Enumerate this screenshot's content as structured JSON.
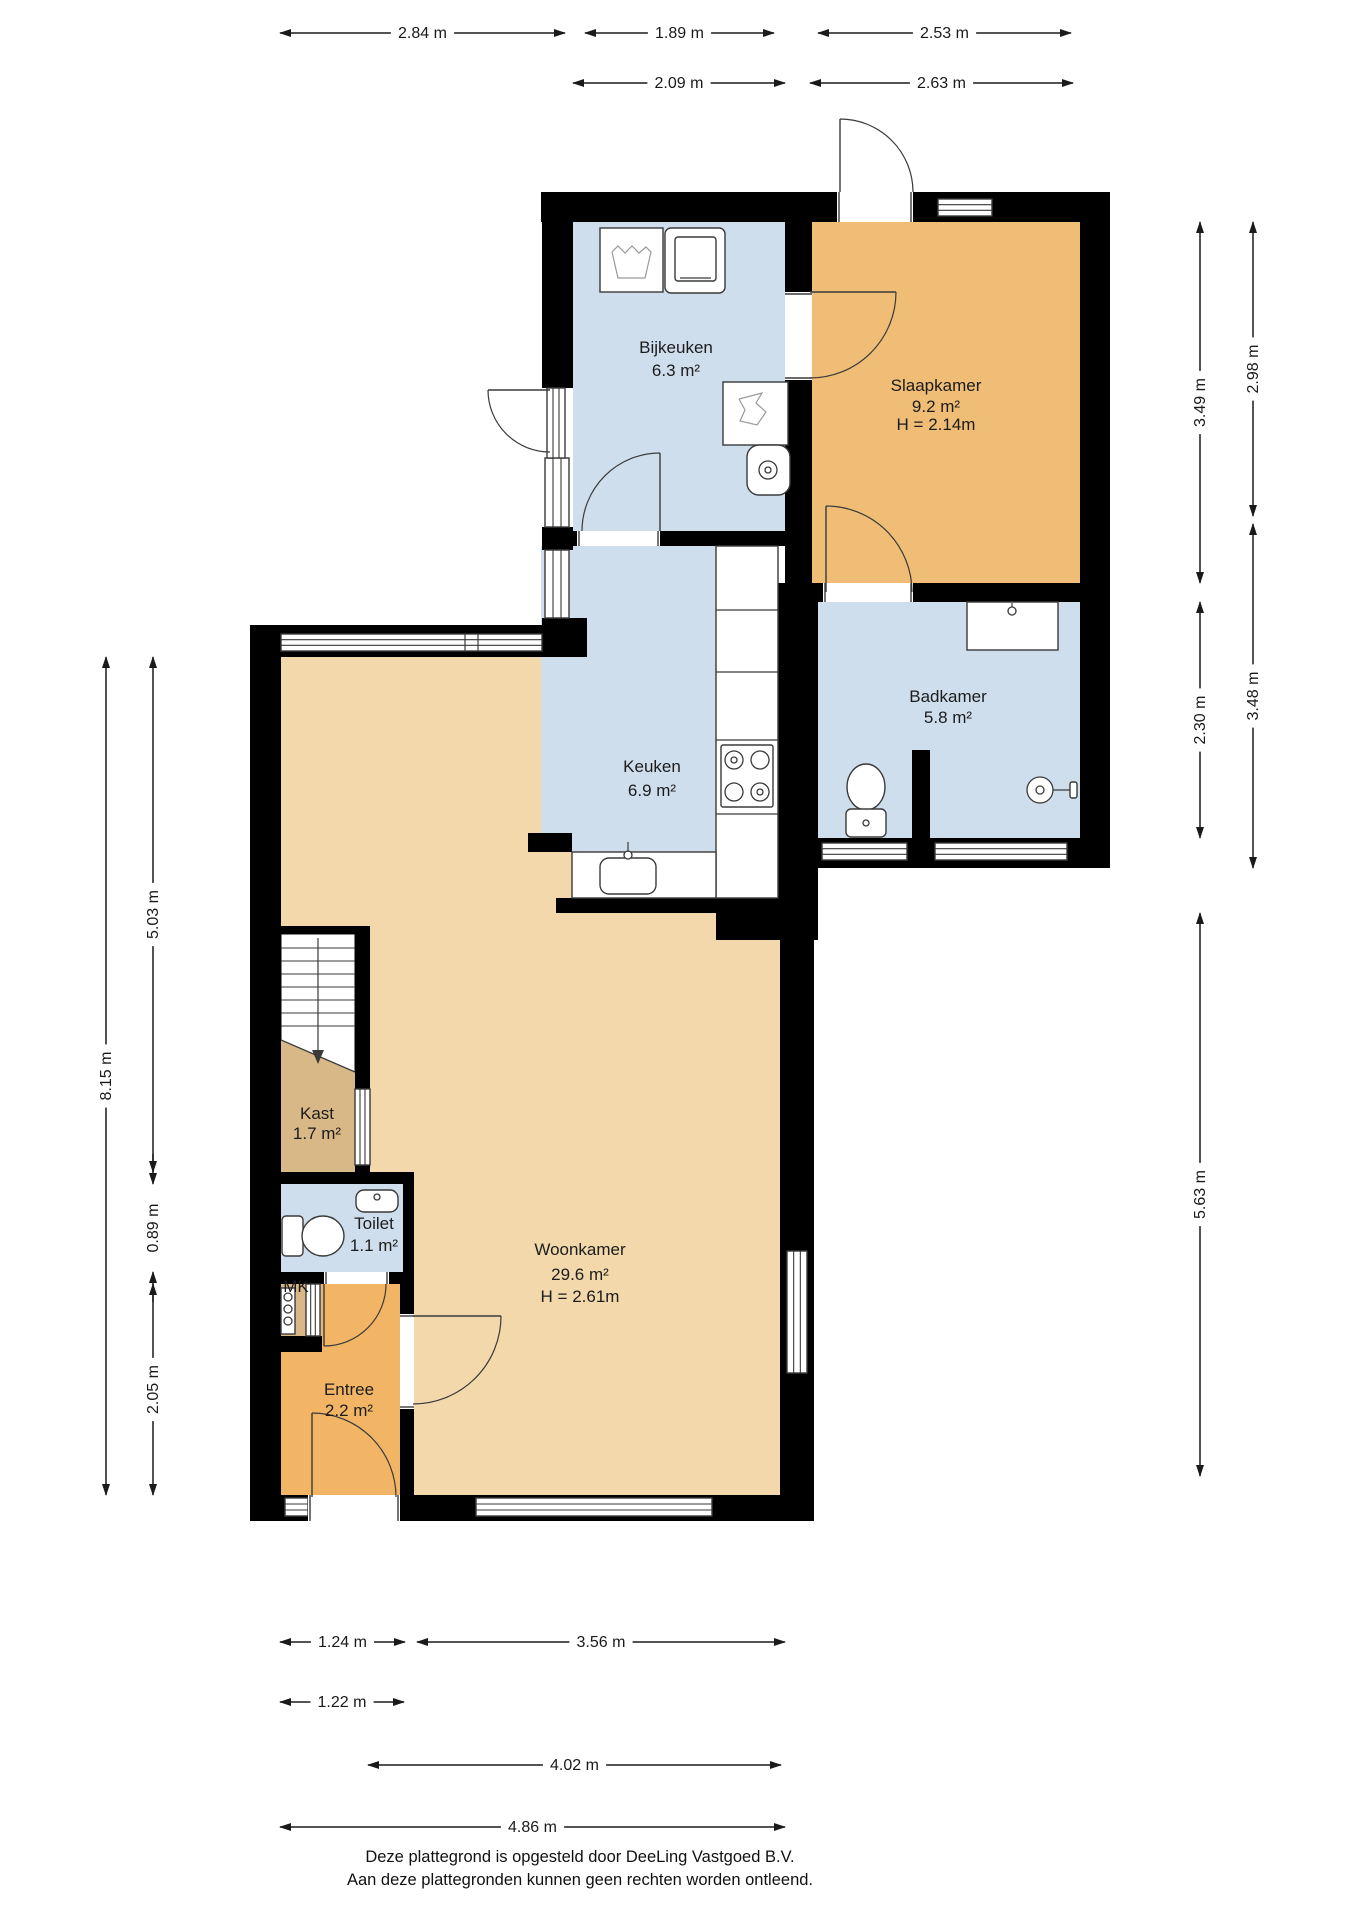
{
  "canvas": {
    "width": 1358,
    "height": 1920,
    "background": "#ffffff"
  },
  "colors": {
    "wall": "#000000",
    "room_blue": "#cfdeed",
    "room_orange": "#efbd75",
    "room_entree": "#f2b566",
    "room_tan": "#f2d8ab",
    "room_darktan": "#d9b887",
    "stroke": "#3a3a3a",
    "dim": "#1a1a1a"
  },
  "plan": {
    "rooms": [
      {
        "id": "woonkamer",
        "color": "#f2d8ab",
        "rect": [
          281,
          657,
          499,
          838
        ],
        "label": {
          "cx": 580,
          "lines": [
            {
              "text": "Woonkamer",
              "y": 1255
            },
            {
              "text": "29.6 m²",
              "y": 1280
            },
            {
              "text": "H = 2.61m",
              "y": 1302
            }
          ]
        }
      },
      {
        "id": "keuken",
        "color": "#cfdeed",
        "rect": [
          541,
          546,
          237,
          306
        ],
        "label": {
          "cx": 652,
          "lines": [
            {
              "text": "Keuken",
              "y": 772
            },
            {
              "text": "6.9 m²",
              "y": 796
            }
          ]
        }
      },
      {
        "id": "bijkeuken",
        "color": "#cfdeed",
        "rect": [
          573,
          222,
          212,
          309
        ],
        "label": {
          "cx": 676,
          "lines": [
            {
              "text": "Bijkeuken",
              "y": 353
            },
            {
              "text": "6.3 m²",
              "y": 376
            }
          ]
        }
      },
      {
        "id": "slaapkamer",
        "color": "#efbd75",
        "rect": [
          812,
          222,
          268,
          361
        ],
        "label": {
          "cx": 936,
          "lines": [
            {
              "text": "Slaapkamer",
              "y": 391
            },
            {
              "text": "9.2 m²",
              "y": 412
            },
            {
              "text": "H = 2.14m",
              "y": 430
            }
          ]
        }
      },
      {
        "id": "badkamer",
        "color": "#cfdeed",
        "rect": [
          818,
          602,
          262,
          236
        ],
        "label": {
          "cx": 948,
          "lines": [
            {
              "text": "Badkamer",
              "y": 702
            },
            {
              "text": "5.8 m²",
              "y": 723
            }
          ]
        }
      },
      {
        "id": "entree",
        "color": "#f2b566",
        "rect": [
          281,
          1284,
          133,
          211
        ],
        "label": {
          "cx": 349,
          "lines": [
            {
              "text": "Entree",
              "y": 1395
            },
            {
              "text": "2.2 m²",
              "y": 1416
            }
          ]
        }
      },
      {
        "id": "kast",
        "color": "#d9b887",
        "rect": [
          281,
          1040,
          74,
          132
        ],
        "label": {
          "cx": 317,
          "lines": [
            {
              "text": "Kast",
              "y": 1119
            },
            {
              "text": "1.7 m²",
              "y": 1139
            }
          ]
        }
      },
      {
        "id": "toilet",
        "color": "#cfdeed",
        "rect": [
          281,
          1184,
          122,
          88
        ],
        "label": {
          "cx": 374,
          "lines": [
            {
              "text": "Toilet",
              "y": 1229
            },
            {
              "text": "1.1 m²",
              "y": 1251
            }
          ]
        }
      },
      {
        "id": "mk",
        "color": "#d9b887",
        "rect": [
          281,
          1284,
          41,
          52
        ],
        "label": {
          "cx": 296,
          "lines": [
            {
              "text": "MK",
              "y": 1292
            }
          ]
        }
      }
    ],
    "walls": [
      [
        541,
        192,
        569,
        30
      ],
      [
        1080,
        192,
        30,
        676
      ],
      [
        542,
        192,
        31,
        196
      ],
      [
        542,
        527,
        31,
        23
      ],
      [
        542,
        618,
        45,
        39
      ],
      [
        785,
        222,
        27,
        361
      ],
      [
        556,
        531,
        229,
        15
      ],
      [
        785,
        583,
        325,
        19
      ],
      [
        778,
        583,
        40,
        330
      ],
      [
        818,
        838,
        292,
        30
      ],
      [
        912,
        750,
        18,
        118
      ],
      [
        528,
        833,
        44,
        19
      ],
      [
        556,
        898,
        160,
        15
      ],
      [
        716,
        898,
        102,
        42
      ],
      [
        250,
        625,
        31,
        896
      ],
      [
        250,
        625,
        323,
        32
      ],
      [
        250,
        1495,
        564,
        26
      ],
      [
        780,
        940,
        34,
        581
      ],
      [
        355,
        926,
        15,
        258
      ],
      [
        281,
        926,
        89,
        8
      ],
      [
        281,
        1172,
        133,
        12
      ],
      [
        403,
        1184,
        11,
        88
      ],
      [
        281,
        1272,
        133,
        12
      ],
      [
        281,
        1336,
        41,
        16
      ],
      [
        400,
        1284,
        14,
        211
      ]
    ],
    "windows": [
      {
        "kind": "win",
        "rect": [
          938,
          199,
          54,
          17
        ],
        "dir": "h"
      },
      {
        "kind": "win",
        "rect": [
          545,
          458,
          24,
          69
        ],
        "dir": "v"
      },
      {
        "kind": "win",
        "rect": [
          545,
          550,
          24,
          68
        ],
        "dir": "v"
      },
      {
        "kind": "win",
        "rect": [
          281,
          634,
          261,
          17
        ],
        "dir": "h"
      },
      {
        "kind": "win",
        "rect": [
          822,
          843,
          85,
          17
        ],
        "dir": "h"
      },
      {
        "kind": "win",
        "rect": [
          935,
          843,
          132,
          17
        ],
        "dir": "h"
      },
      {
        "kind": "win",
        "rect": [
          787,
          1251,
          20,
          122
        ],
        "dir": "v"
      },
      {
        "kind": "win",
        "rect": [
          355,
          1089,
          15,
          76
        ],
        "dir": "v"
      },
      {
        "kind": "win",
        "rect": [
          285,
          1498,
          23,
          18
        ],
        "dir": "h"
      },
      {
        "kind": "win",
        "rect": [
          476,
          1498,
          236,
          18
        ],
        "dir": "h"
      },
      {
        "kind": "win",
        "rect": [
          306,
          1284,
          14,
          52
        ],
        "dir": "v"
      },
      {
        "kind": "win",
        "rect": [
          547,
          388,
          18,
          70
        ],
        "dir": "v"
      },
      {
        "kind": "gap",
        "rect": [
          837,
          192,
          76,
          30
        ],
        "dir": "h"
      },
      {
        "kind": "gap",
        "rect": [
          785,
          292,
          27,
          88
        ],
        "dir": "v"
      },
      {
        "kind": "gap",
        "rect": [
          577,
          531,
          83,
          15
        ],
        "dir": "h"
      },
      {
        "kind": "gap",
        "rect": [
          823,
          583,
          90,
          19
        ],
        "dir": "h"
      },
      {
        "kind": "gap",
        "rect": [
          400,
          1314,
          14,
          95
        ],
        "dir": "v"
      },
      {
        "kind": "gap",
        "rect": [
          324,
          1272,
          65,
          12
        ],
        "dir": "h"
      },
      {
        "kind": "gap",
        "rect": [
          308,
          1495,
          92,
          26
        ],
        "dir": "h"
      }
    ],
    "doors": [
      {
        "name": "door-exterior-top",
        "h": [
          840,
          192
        ],
        "r": 73,
        "from": -90,
        "to": 0
      },
      {
        "name": "door-exterior-bijkeuken",
        "h": [
          550,
          390
        ],
        "r": 62,
        "from": 180,
        "to": 90
      },
      {
        "name": "door-bijkeuken-keuken",
        "h": [
          660,
          531
        ],
        "r": 78,
        "from": 270,
        "to": 180
      },
      {
        "name": "door-bijkeuken-slaapkamer",
        "h": [
          810,
          292
        ],
        "r": 86,
        "from": 0,
        "to": 90
      },
      {
        "name": "door-slaapkamer-badkamer",
        "h": [
          826,
          592
        ],
        "r": 86,
        "from": -90,
        "to": 0
      },
      {
        "name": "door-toilet-entree",
        "h": [
          324,
          1284
        ],
        "r": 62,
        "from": 90,
        "to": 0
      },
      {
        "name": "door-entree-woonkamer",
        "h": [
          413,
          1316
        ],
        "r": 88,
        "from": 0,
        "to": 90
      },
      {
        "name": "door-front-entrance",
        "h": [
          312,
          1497
        ],
        "r": 84,
        "from": -90,
        "to": 0
      }
    ],
    "fixtures": [
      {
        "name": "washing-machine",
        "parts": [
          {
            "r": [
              600,
              228,
              63,
              64
            ]
          },
          {
            "p": "612,252 618,246 625,253 632,246 639,253 646,247 651,252 645,278 618,278 612,252"
          }
        ]
      },
      {
        "name": "dryer",
        "parts": [
          {
            "r": [
              665,
              228,
              60,
              65,
              6
            ]
          },
          {
            "r": [
              675,
              237,
              41,
              44,
              3
            ]
          },
          {
            "l": [
              680,
              278,
              711,
              278
            ]
          }
        ]
      },
      {
        "name": "laundry-basket",
        "parts": [
          {
            "r": [
              723,
              382,
              65,
              63
            ]
          },
          {
            "p": "739,399 762,393 756,403 766,412 757,425 740,421 745,410 739,399"
          }
        ]
      },
      {
        "name": "boiler",
        "parts": [
          {
            "r": [
              747,
              445,
              43,
              50,
              12
            ]
          },
          {
            "c": [
              768,
              470,
              9
            ]
          },
          {
            "c": [
              768,
              470,
              3
            ]
          }
        ]
      },
      {
        "name": "kitchen-counter",
        "parts": [
          {
            "r": [
              716,
              546,
              62,
              352
            ]
          },
          {
            "l": [
              716,
              610,
              778,
              610
            ]
          },
          {
            "l": [
              716,
              672,
              778,
              672
            ]
          },
          {
            "l": [
              716,
              740,
              778,
              740
            ]
          },
          {
            "l": [
              716,
              814,
              778,
              814
            ]
          }
        ]
      },
      {
        "name": "stove",
        "parts": [
          {
            "r": [
              721,
              745,
              52,
              62,
              2
            ]
          },
          {
            "c": [
              734,
              760,
              9
            ]
          },
          {
            "c": [
              760,
              760,
              9
            ]
          },
          {
            "c": [
              734,
              792,
              9
            ]
          },
          {
            "c": [
              760,
              792,
              9
            ]
          },
          {
            "c": [
              734,
              760,
              3
            ]
          },
          {
            "c": [
              760,
              792,
              3
            ]
          }
        ]
      },
      {
        "name": "kitchen-sink",
        "parts": [
          {
            "r": [
              572,
              852,
              144,
              46
            ]
          },
          {
            "r": [
              600,
              858,
              56,
              36,
              9
            ]
          },
          {
            "c": [
              628,
              855,
              4
            ]
          },
          {
            "l": [
              628,
              842,
              628,
              852
            ]
          }
        ]
      },
      {
        "name": "bathroom-vanity",
        "parts": [
          {
            "r": [
              967,
              602,
              91,
              48
            ]
          },
          {
            "c": [
              1012,
              611,
              4
            ]
          },
          {
            "l": [
              1012,
              603,
              1012,
              607
            ]
          }
        ]
      },
      {
        "name": "bathroom-toilet",
        "parts": [
          {
            "e": [
              866,
              787,
              19,
              23
            ]
          },
          {
            "r": [
              846,
              809,
              40,
              28,
              5
            ]
          },
          {
            "c": [
              866,
              823,
              3
            ]
          }
        ]
      },
      {
        "name": "shower-head",
        "parts": [
          {
            "c": [
              1040,
              790,
              13
            ]
          },
          {
            "c": [
              1040,
              790,
              4
            ]
          },
          {
            "l": [
              1053,
              790,
              1072,
              790
            ]
          },
          {
            "r": [
              1070,
              782,
              7,
              16,
              2
            ]
          }
        ]
      },
      {
        "name": "toilet-washbasin",
        "parts": [
          {
            "r": [
              356,
              1190,
              42,
              22,
              8
            ]
          },
          {
            "c": [
              377,
              1197,
              3
            ]
          }
        ]
      },
      {
        "name": "toilet-wc",
        "parts": [
          {
            "r": [
              282,
              1216,
              21,
              40,
              4
            ]
          },
          {
            "e": [
              323,
              1236,
              21,
              20
            ]
          }
        ]
      },
      {
        "name": "meter-cabinet",
        "parts": [
          {
            "r": [
              281,
              1288,
              14,
              46
            ]
          },
          {
            "c": [
              288,
              1297,
              4
            ]
          },
          {
            "c": [
              288,
              1309,
              4
            ]
          },
          {
            "c": [
              288,
              1321,
              4
            ]
          }
        ]
      },
      {
        "name": "window-mullion",
        "parts": [
          {
            "l": [
              465,
              634,
              465,
              651
            ]
          },
          {
            "l": [
              478,
              634,
              478,
              651
            ]
          }
        ]
      }
    ],
    "stairs": {
      "x": 281,
      "y": 934,
      "w": 74,
      "cutl": 1040,
      "cutr": 1072,
      "treads": [
        948,
        961,
        974,
        987,
        1000,
        1013,
        1026
      ],
      "center": 318,
      "arrow_y": 1062
    }
  },
  "dimensions": [
    {
      "label": "2.84 m",
      "kind": "h",
      "a": 280,
      "b": 565,
      "pos": 33
    },
    {
      "label": "1.89 m",
      "kind": "h",
      "a": 585,
      "b": 774,
      "pos": 33
    },
    {
      "label": "2.53 m",
      "kind": "h",
      "a": 818,
      "b": 1071,
      "pos": 33
    },
    {
      "label": "2.09 m",
      "kind": "h",
      "a": 573,
      "b": 785,
      "pos": 83
    },
    {
      "label": "2.63 m",
      "kind": "h",
      "a": 810,
      "b": 1073,
      "pos": 83
    },
    {
      "label": "3.49 m",
      "kind": "v",
      "a": 222,
      "b": 583,
      "pos": 1200
    },
    {
      "label": "2.30 m",
      "kind": "v",
      "a": 602,
      "b": 838,
      "pos": 1200
    },
    {
      "label": "5.63 m",
      "kind": "v",
      "a": 913,
      "b": 1476,
      "pos": 1200
    },
    {
      "label": "2.98 m",
      "kind": "v",
      "a": 222,
      "b": 516,
      "pos": 1253
    },
    {
      "label": "3.48 m",
      "kind": "v",
      "a": 524,
      "b": 868,
      "pos": 1253
    },
    {
      "label": "8.15 m",
      "kind": "v",
      "a": 657,
      "b": 1495,
      "pos": 106
    },
    {
      "label": "5.03 m",
      "kind": "v",
      "a": 657,
      "b": 1172,
      "pos": 153
    },
    {
      "label": "0.89 m",
      "kind": "vout",
      "a": 1184,
      "b": 1272,
      "pos": 153
    },
    {
      "label": "2.05 m",
      "kind": "v",
      "a": 1284,
      "b": 1495,
      "pos": 153
    },
    {
      "label": "1.24 m",
      "kind": "h",
      "a": 280,
      "b": 405,
      "pos": 1642
    },
    {
      "label": "3.56 m",
      "kind": "h",
      "a": 417,
      "b": 785,
      "pos": 1642
    },
    {
      "label": "1.22 m",
      "kind": "h",
      "a": 280,
      "b": 404,
      "pos": 1702
    },
    {
      "label": "4.02 m",
      "kind": "h",
      "a": 368,
      "b": 781,
      "pos": 1765
    },
    {
      "label": "4.86 m",
      "kind": "h",
      "a": 280,
      "b": 785,
      "pos": 1827
    }
  ],
  "footer": {
    "line1": "Deze plattegrond is opgesteld door DeeLing Vastgoed B.V.",
    "line2": "Aan deze plattegronden kunnen geen rechten worden ontleend."
  }
}
